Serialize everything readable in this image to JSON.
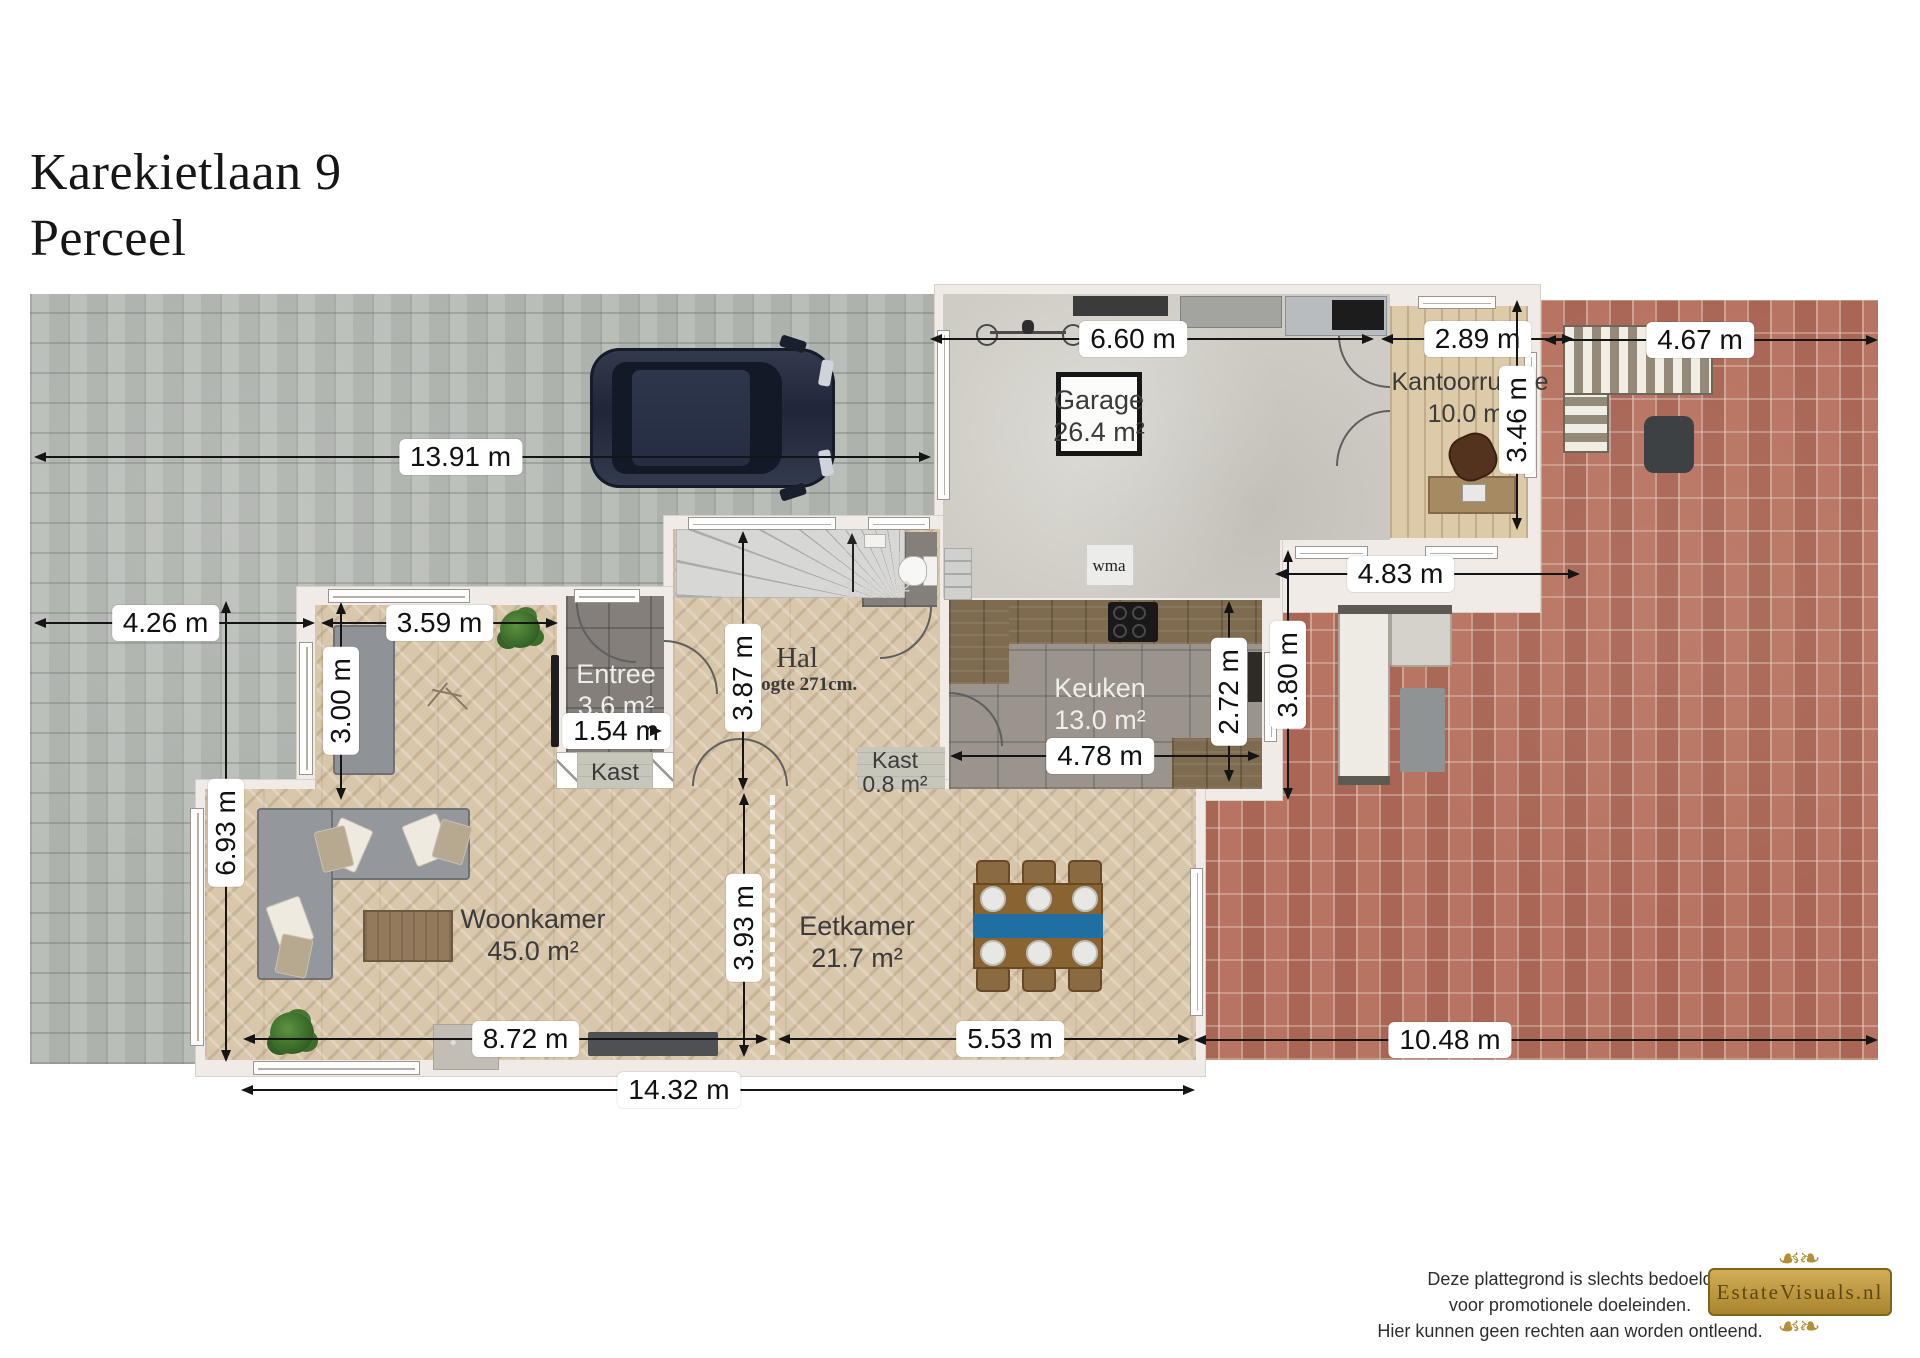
{
  "title": {
    "line1": "Karekietlaan 9",
    "line2": "Perceel"
  },
  "rooms": {
    "garage": {
      "name": "Garage",
      "area": "26.4 m²"
    },
    "kantoorruimte": {
      "name": "Kantoorruimte",
      "area": "10.0 m²"
    },
    "entree": {
      "name": "Entree",
      "area": "3.6 m²"
    },
    "hal": {
      "name": "Hal",
      "height_note": "Hoogte 271cm."
    },
    "toilet": {
      "area": "1.4 m²"
    },
    "keuken": {
      "name": "Keuken",
      "area": "13.0 m²"
    },
    "kast_hal": {
      "name": "Kast",
      "area": "0.8 m²"
    },
    "kast_entree": {
      "name": "Kast"
    },
    "woonkamer": {
      "name": "Woonkamer",
      "area": "45.0 m²"
    },
    "eetkamer": {
      "name": "Eetkamer",
      "area": "21.7 m²"
    },
    "wasmachine": {
      "label": "wma"
    }
  },
  "dimensions": {
    "driveway_width": {
      "text": "13.91 m"
    },
    "garage_width": {
      "text": "6.60 m"
    },
    "kantoor_width": {
      "text": "2.89 m"
    },
    "patio_top_width": {
      "text": "4.67 m"
    },
    "kantoor_depth": {
      "text": "3.46 m"
    },
    "front_left_width": {
      "text": "4.26 m"
    },
    "sitting_width": {
      "text": "3.59 m"
    },
    "sitting_depth": {
      "text": "3.00 m"
    },
    "entree_width": {
      "text": "1.54 m"
    },
    "hal_depth": {
      "text": "3.87 m"
    },
    "patio_strip_width": {
      "text": "4.83 m"
    },
    "keuken_width": {
      "text": "4.78 m"
    },
    "keuken_depth": {
      "text": "2.72 m"
    },
    "patio_depth": {
      "text": "3.80 m"
    },
    "garden_left_depth": {
      "text": "6.93 m"
    },
    "living_depth": {
      "text": "3.93 m"
    },
    "woonkamer_width": {
      "text": "8.72 m"
    },
    "eetkamer_width": {
      "text": "5.53 m"
    },
    "patio_width": {
      "text": "10.48 m"
    },
    "house_width": {
      "text": "14.32 m"
    }
  },
  "footer": {
    "disclaimer": [
      "Deze plattegrond is slechts bedoeld",
      "voor promotionele doeleinden.",
      "Hier kunnen geen rechten aan worden ontleend."
    ],
    "logo": "EstateVisuals.nl"
  },
  "palette": {
    "brick": "#b26e5d",
    "paving": "#b6bbb5",
    "wood_floor": "#d9c7ab",
    "accent_blue": "#1f6fa3",
    "logo_gold": "#b8923e"
  }
}
